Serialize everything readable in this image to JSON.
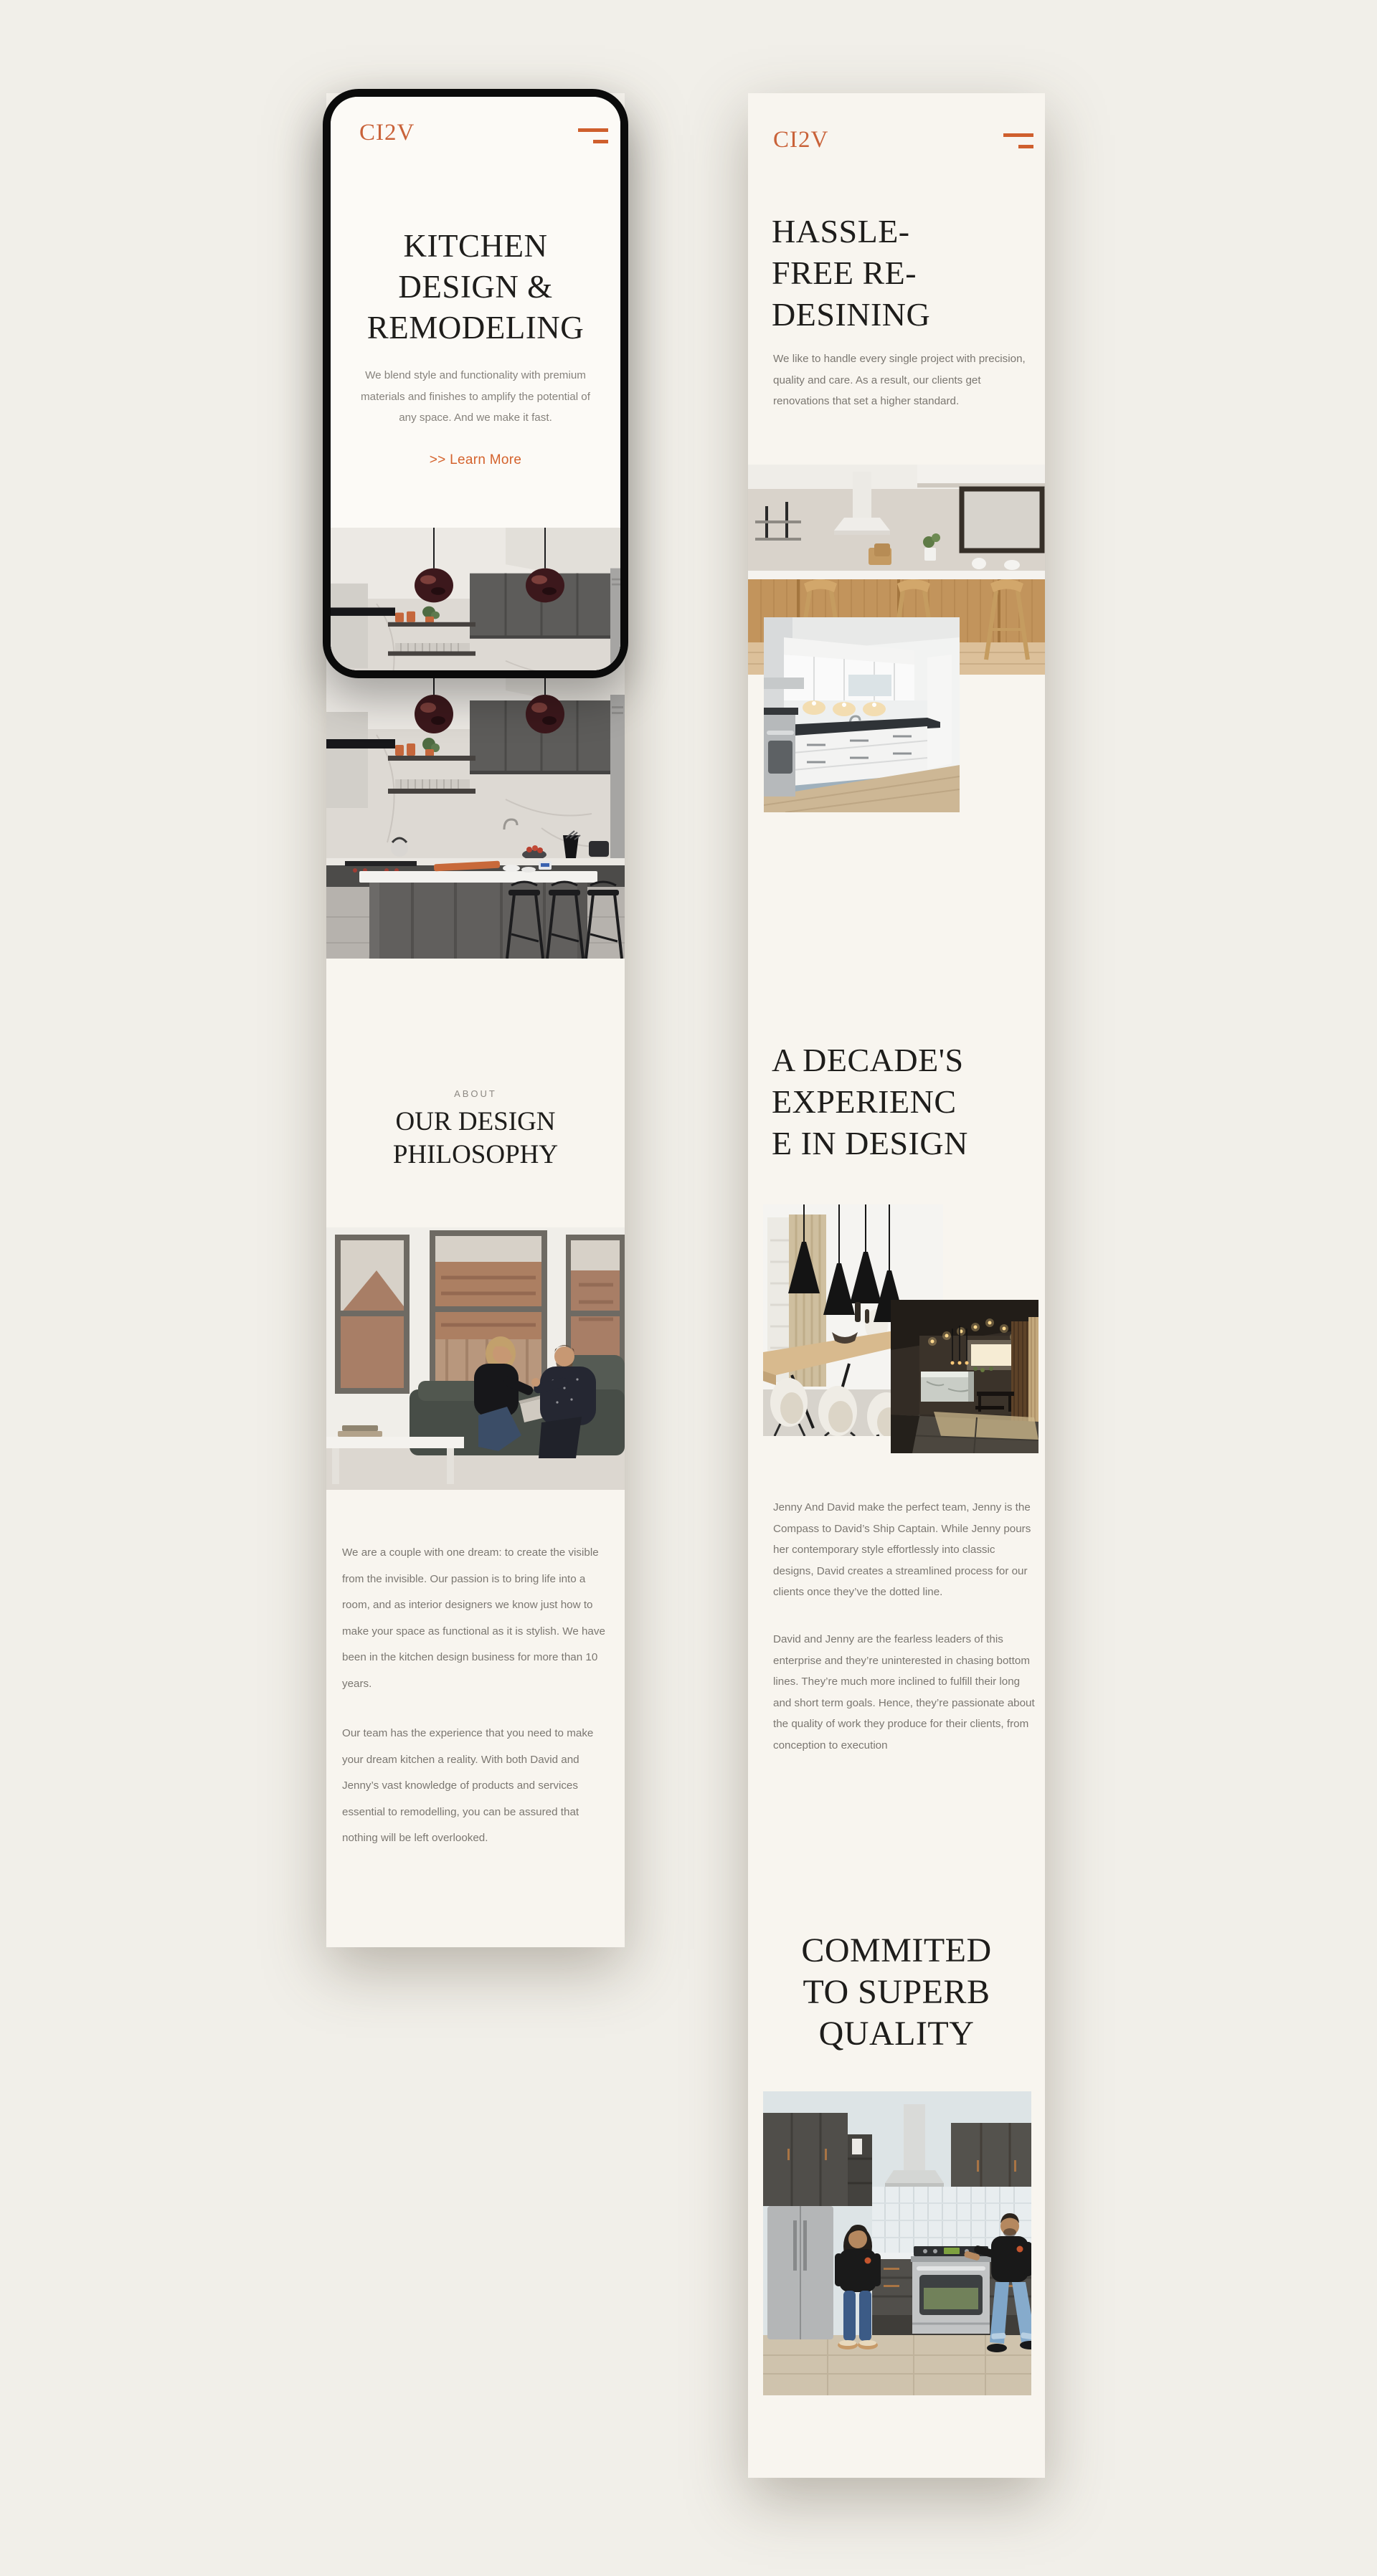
{
  "theme": {
    "accent": "#cf5f2d",
    "page_bg": "#f1efe9",
    "panel_bg": "#f8f5ef",
    "heading_color": "#1e1d1b",
    "body_color": "#7b7771"
  },
  "phone": {
    "logo": "CI2V",
    "menu_icon": "hamburger-menu",
    "hero_heading_lines": [
      "KITCHEN",
      "DESIGN &",
      "REMODELING"
    ],
    "hero_paragraph": "We blend style and functionality with premium materials and finishes to amplify the potential of any space. And we make it fast.",
    "learn_more_label": ">> Learn More",
    "hero_image": "dark-kitchen-photo"
  },
  "left_page": {
    "kitchen_image": "dark-kitchen-photo",
    "about_label": "ABOUT",
    "about_heading_lines": [
      "OUR DESIGN",
      "PHILOSOPHY"
    ],
    "team_image": "couple-on-couch-photo",
    "paragraph_1": "We are a couple with one dream: to create the visible from the invisible. Our passion is to bring life into a room, and as interior designers we know just how to make your space as functional as it is stylish. We have been in the kitchen design business for more than 10 years.",
    "paragraph_2": "Our team has the experience that you need to make your dream kitchen a reality. With both David and Jenny’s vast knowledge of products and services essential to remodelling, you can be assured that nothing will be left overlooked."
  },
  "right_page": {
    "logo": "CI2V",
    "menu_icon": "hamburger-menu",
    "heading_1_lines": [
      "HASSLE-",
      "FREE RE-",
      "DESINING"
    ],
    "paragraph_1": "We like to handle every single project with precision, quality and care. As a result, our clients get renovations that set a higher standard.",
    "image_1": "wood-kitchen-photo",
    "image_2": "white-kitchen-photo",
    "heading_2_lines": [
      "A DECADE'S",
      "EXPERIENC",
      "E IN DESIGN"
    ],
    "image_3": "dining-room-photo",
    "image_4": "dark-showroom-photo",
    "paragraph_2": "Jenny And David make the perfect team, Jenny is the Compass to David’s Ship Captain. While Jenny pours her contemporary style effortlessly into classic designs, David creates a streamlined process for our clients once they’ve the dotted line.",
    "paragraph_3": "David and Jenny are the fearless leaders of this enterprise and they’re uninterested in chasing bottom lines. They’re much more inclined to fulfill their long and short term goals. Hence, they’re passionate about the quality of work they produce for their clients, from conception to execution",
    "heading_3_lines": [
      "COMMITED",
      "TO SUPERB",
      "QUALITY"
    ],
    "image_5": "owners-in-kitchen-photo"
  }
}
